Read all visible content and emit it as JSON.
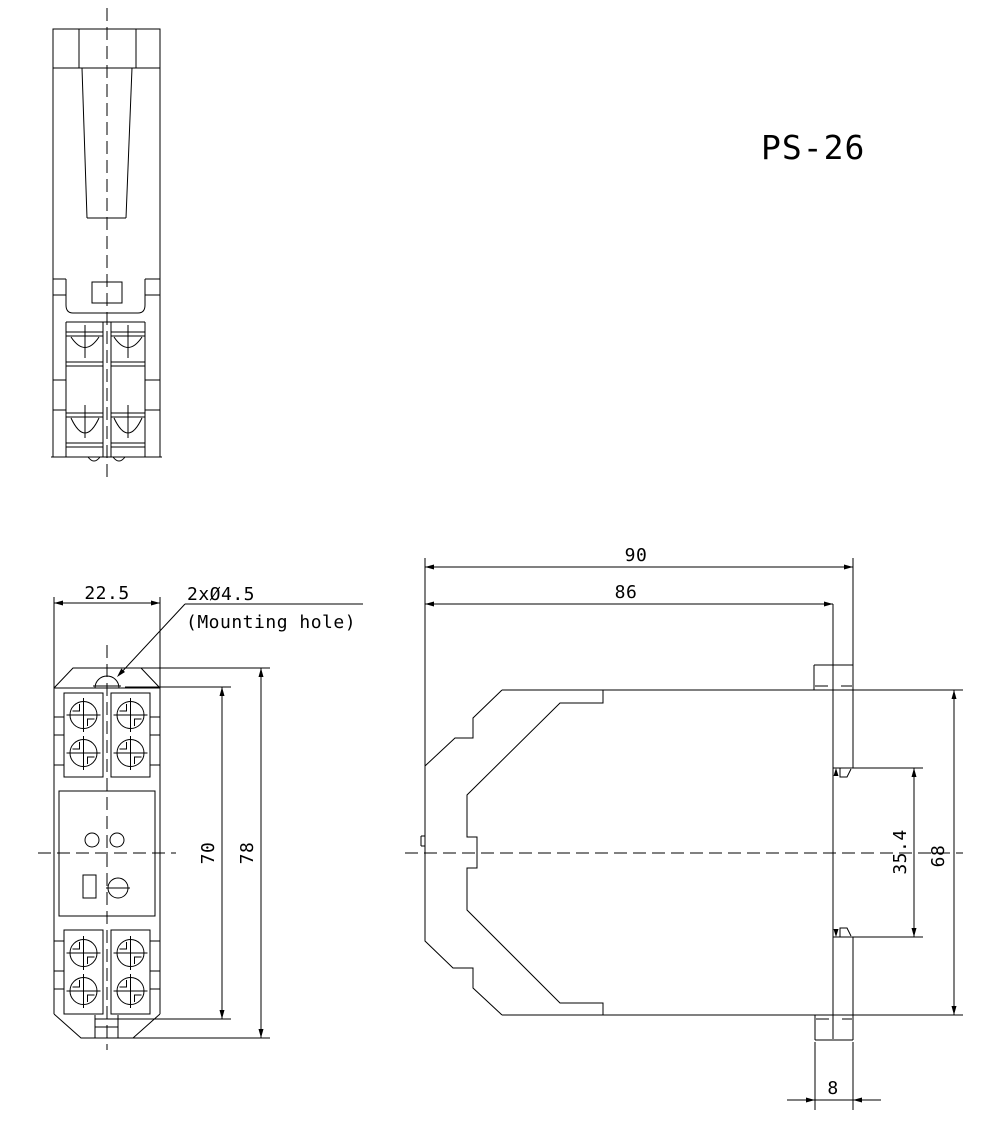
{
  "title": "PS-26",
  "colors": {
    "line": "#000000",
    "background": "#ffffff"
  },
  "top_view": {
    "description": "top view of DIN-rail power supply unit"
  },
  "front_view": {
    "width_dim": "22.5",
    "height_inner_dim": "70",
    "height_outer_dim": "78",
    "mounting_hole_label": "2xØ4.5",
    "mounting_hole_note": "(Mounting hole)"
  },
  "side_view": {
    "depth_outer_dim": "90",
    "depth_inner_dim": "86",
    "height_dim": "68",
    "din_slot_dim": "35.4",
    "tab_width_dim": "8"
  }
}
